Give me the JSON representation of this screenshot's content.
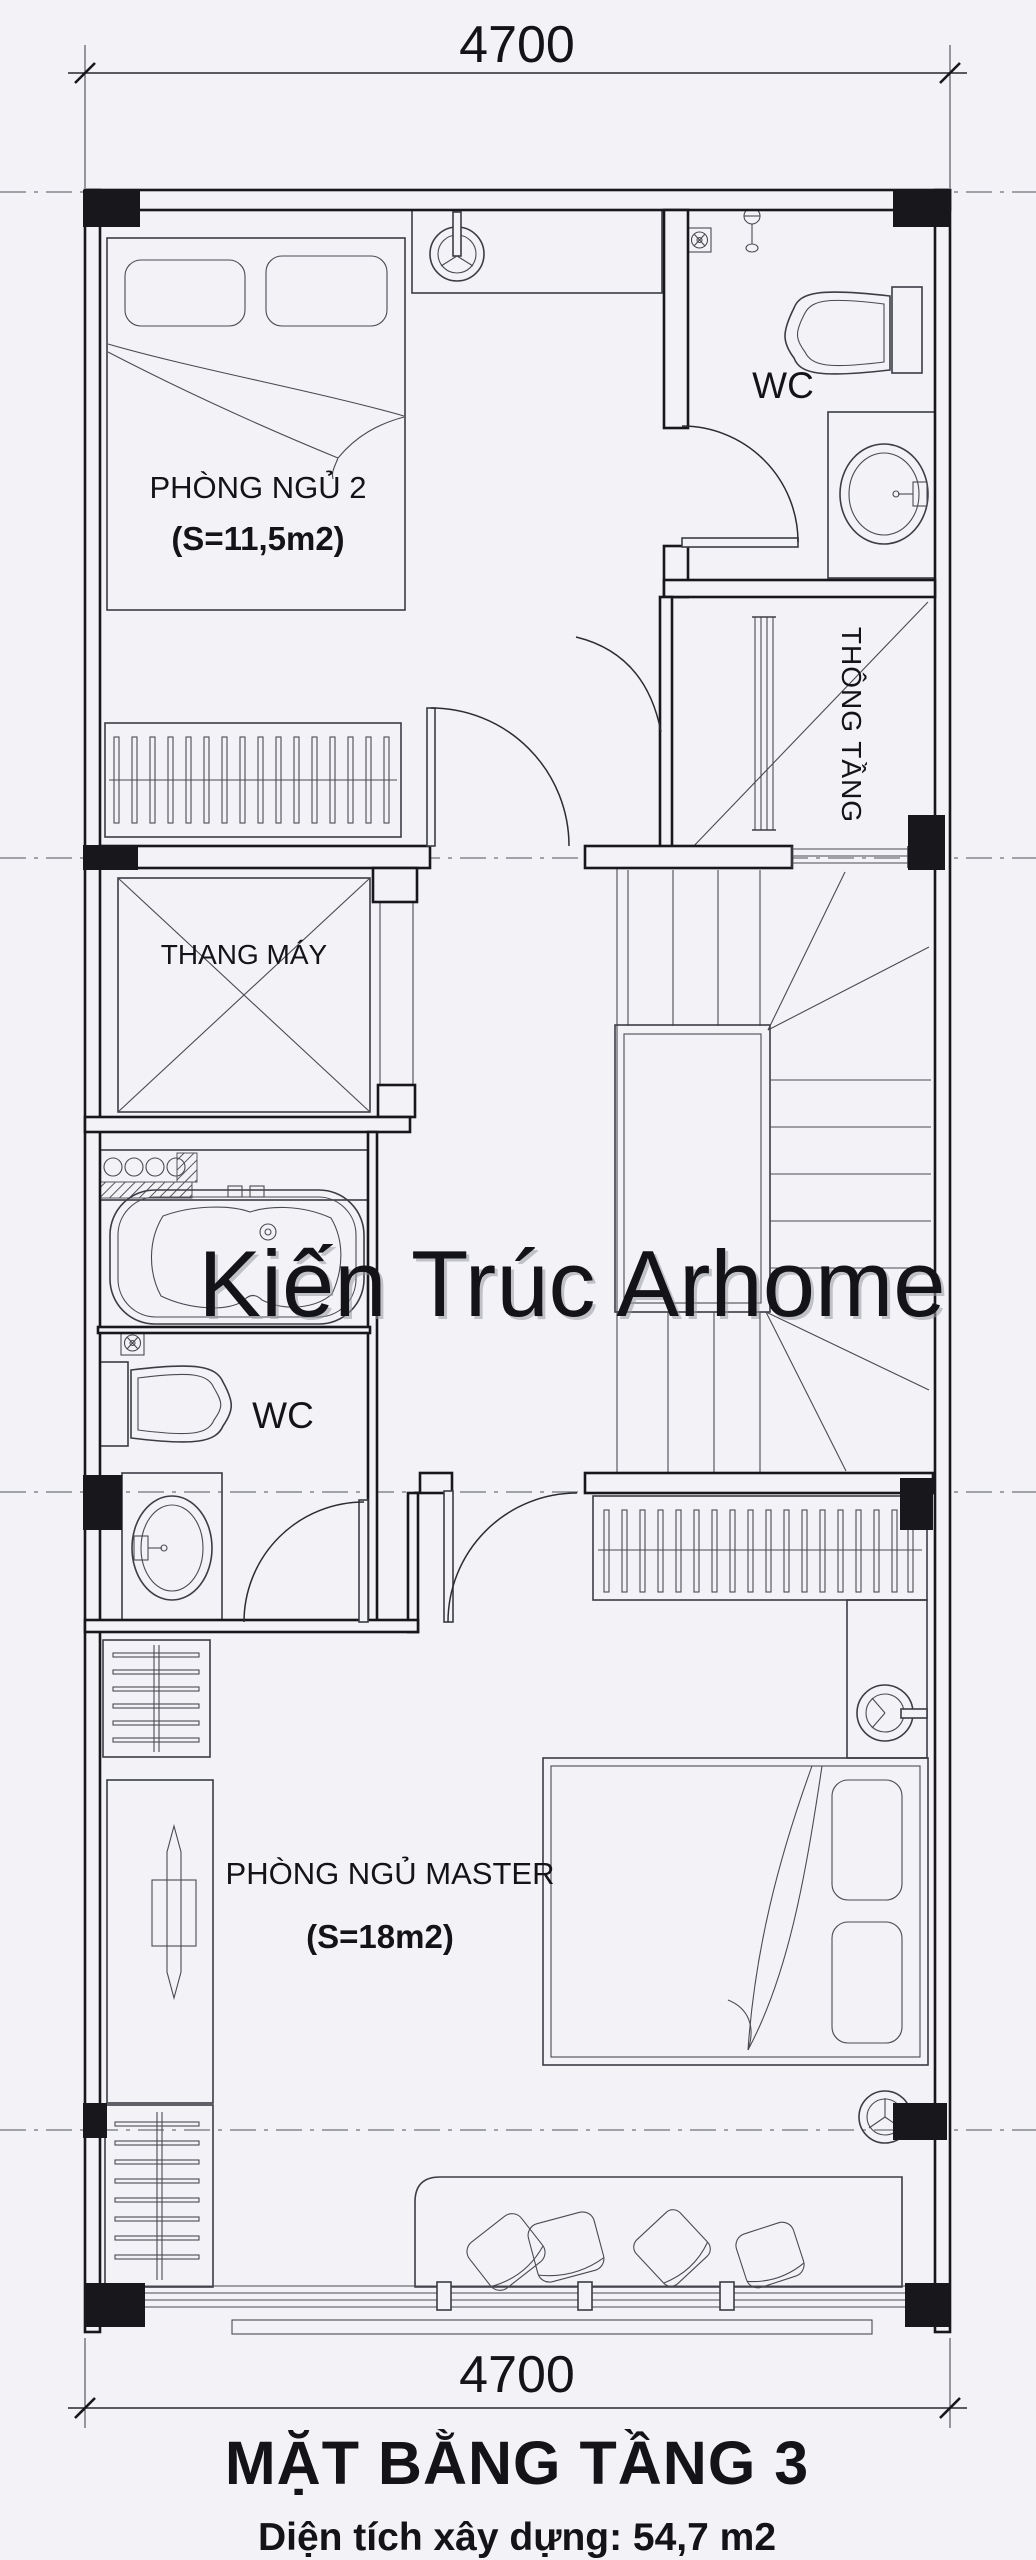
{
  "colors": {
    "background": "#f3f3f7",
    "line": "#17171c",
    "watermark": "#161616"
  },
  "dimensions": {
    "top": "4700",
    "bottom": "4700"
  },
  "rooms": {
    "bedroom2": {
      "name": "PHÒNG NGỦ 2",
      "area": "(S=11,5m2)"
    },
    "wc_top": {
      "name": "WC"
    },
    "void": {
      "name": "THÔNG TẦNG"
    },
    "elevator": {
      "name": "THANG MÁY"
    },
    "wc_master": {
      "name": "WC"
    },
    "master": {
      "name": "PHÒNG NGỦ MASTER",
      "area": "(S=18m2)"
    }
  },
  "fixtures": [
    "double-bed",
    "pillows",
    "wardrobe-hangers",
    "ceiling-fan",
    "exhaust-fan",
    "toilet",
    "vanity-sink",
    "bathtub",
    "elevator-shaft",
    "staircase",
    "dressing-table",
    "floor-cushions",
    "balcony-railing"
  ],
  "watermark": {
    "text": "Kiến Trúc Arhome"
  },
  "footer": {
    "title": "MẶT BẰNG TẦNG 3",
    "subtitle": "Diện tích xây dựng: 54,7 m2"
  }
}
